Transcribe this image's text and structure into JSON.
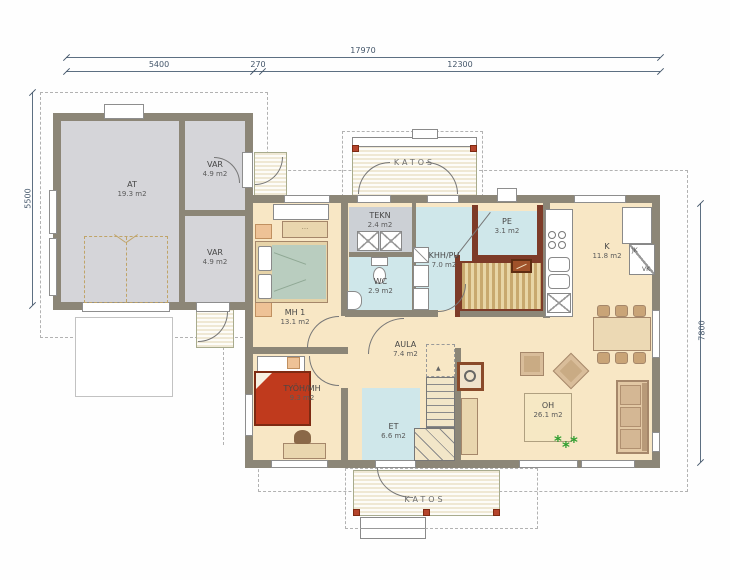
{
  "drawing": {
    "dimensions": {
      "top_total": "17970",
      "top_left": "5400",
      "top_gap": "270",
      "top_right": "12300",
      "left_height": "5500",
      "right_height": "7800"
    },
    "porches": {
      "top": "KATOS",
      "bottom": "KATOS"
    },
    "rooms": [
      {
        "name": "AT",
        "area": "19.3 m2"
      },
      {
        "name": "VAR",
        "area": "4.9 m2"
      },
      {
        "name": "VAR",
        "area": "4.9 m2"
      },
      {
        "name": "MH 1",
        "area": "13.1 m2"
      },
      {
        "name": "TYÖH/MH",
        "area": "9.3 m2"
      },
      {
        "name": "TEKN",
        "area": "2.4 m2"
      },
      {
        "name": "WC",
        "area": "2.9 m2"
      },
      {
        "name": "KHH/PU",
        "area": "7.0 m2"
      },
      {
        "name": "PE",
        "area": "3.1 m2"
      },
      {
        "name": "K",
        "area": "11.8 m2"
      },
      {
        "name": "AULA",
        "area": "7.4 m2"
      },
      {
        "name": "ET",
        "area": "6.6 m2"
      },
      {
        "name": "OH",
        "area": "26.1 m2"
      }
    ],
    "kitchen_units": {
      "jk": "JK",
      "vk": "VK"
    },
    "colors": {
      "wall": "#8c8677",
      "floor_living": "#f8e7c5",
      "floor_wet": "#cfe7ea",
      "floor_garage": "#d5d5d9",
      "sauna_wall": "#7d3b28",
      "post_red": "#b5442c",
      "bed_green": "#b9cdbf",
      "bed_red": "#c03a1d"
    }
  }
}
